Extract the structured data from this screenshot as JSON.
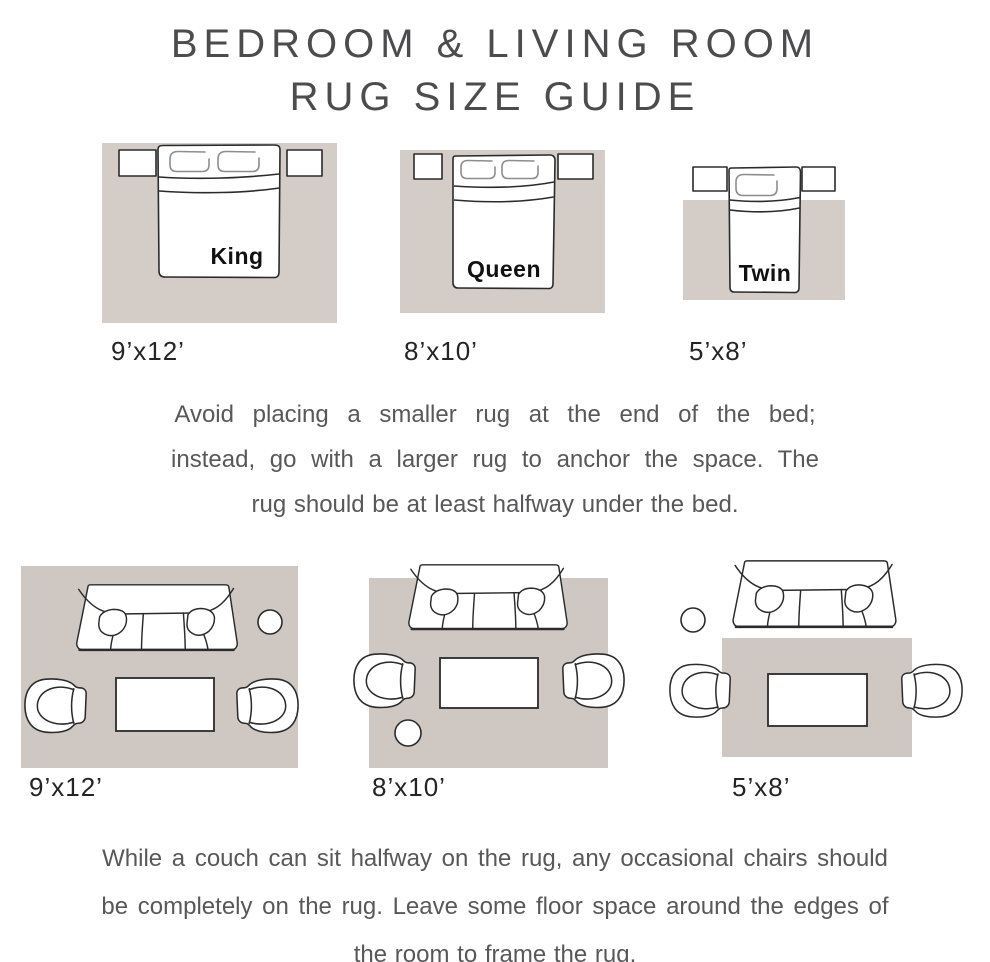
{
  "title": {
    "line1": "BEDROOM & LIVING ROOM",
    "line2": "RUG SIZE GUIDE"
  },
  "colors": {
    "background": "#ffffff",
    "rug_bedroom": "#d3ccc7",
    "rug_living": "#cfc7c1",
    "furniture_fill": "#ffffff",
    "furniture_outline": "#2b2b2b",
    "pillow_outline": "#8d8d8d",
    "title_text": "#4c4c4e",
    "body_text": "#58585a",
    "size_label_text": "#242424",
    "bed_label_text": "#111111"
  },
  "bedroom_section": {
    "diagrams": [
      {
        "bed_label": "King",
        "rug_size": "9’x12’"
      },
      {
        "bed_label": "Queen",
        "rug_size": "8’x10’"
      },
      {
        "bed_label": "Twin",
        "rug_size": "5’x8’"
      }
    ],
    "note_lines": [
      "Avoid placing a smaller rug at the end of the bed;",
      "instead, go with a larger rug to anchor the space. The",
      "rug should be at least halfway under the bed."
    ]
  },
  "living_section": {
    "diagrams": [
      {
        "rug_size": "9’x12’"
      },
      {
        "rug_size": "8’x10’"
      },
      {
        "rug_size": "5’x8’"
      }
    ],
    "note_lines": [
      "While a couch can sit halfway on the rug, any occasional chairs should",
      "be completely on the rug. Leave some floor space around the edges of",
      "the room to frame the rug."
    ]
  }
}
